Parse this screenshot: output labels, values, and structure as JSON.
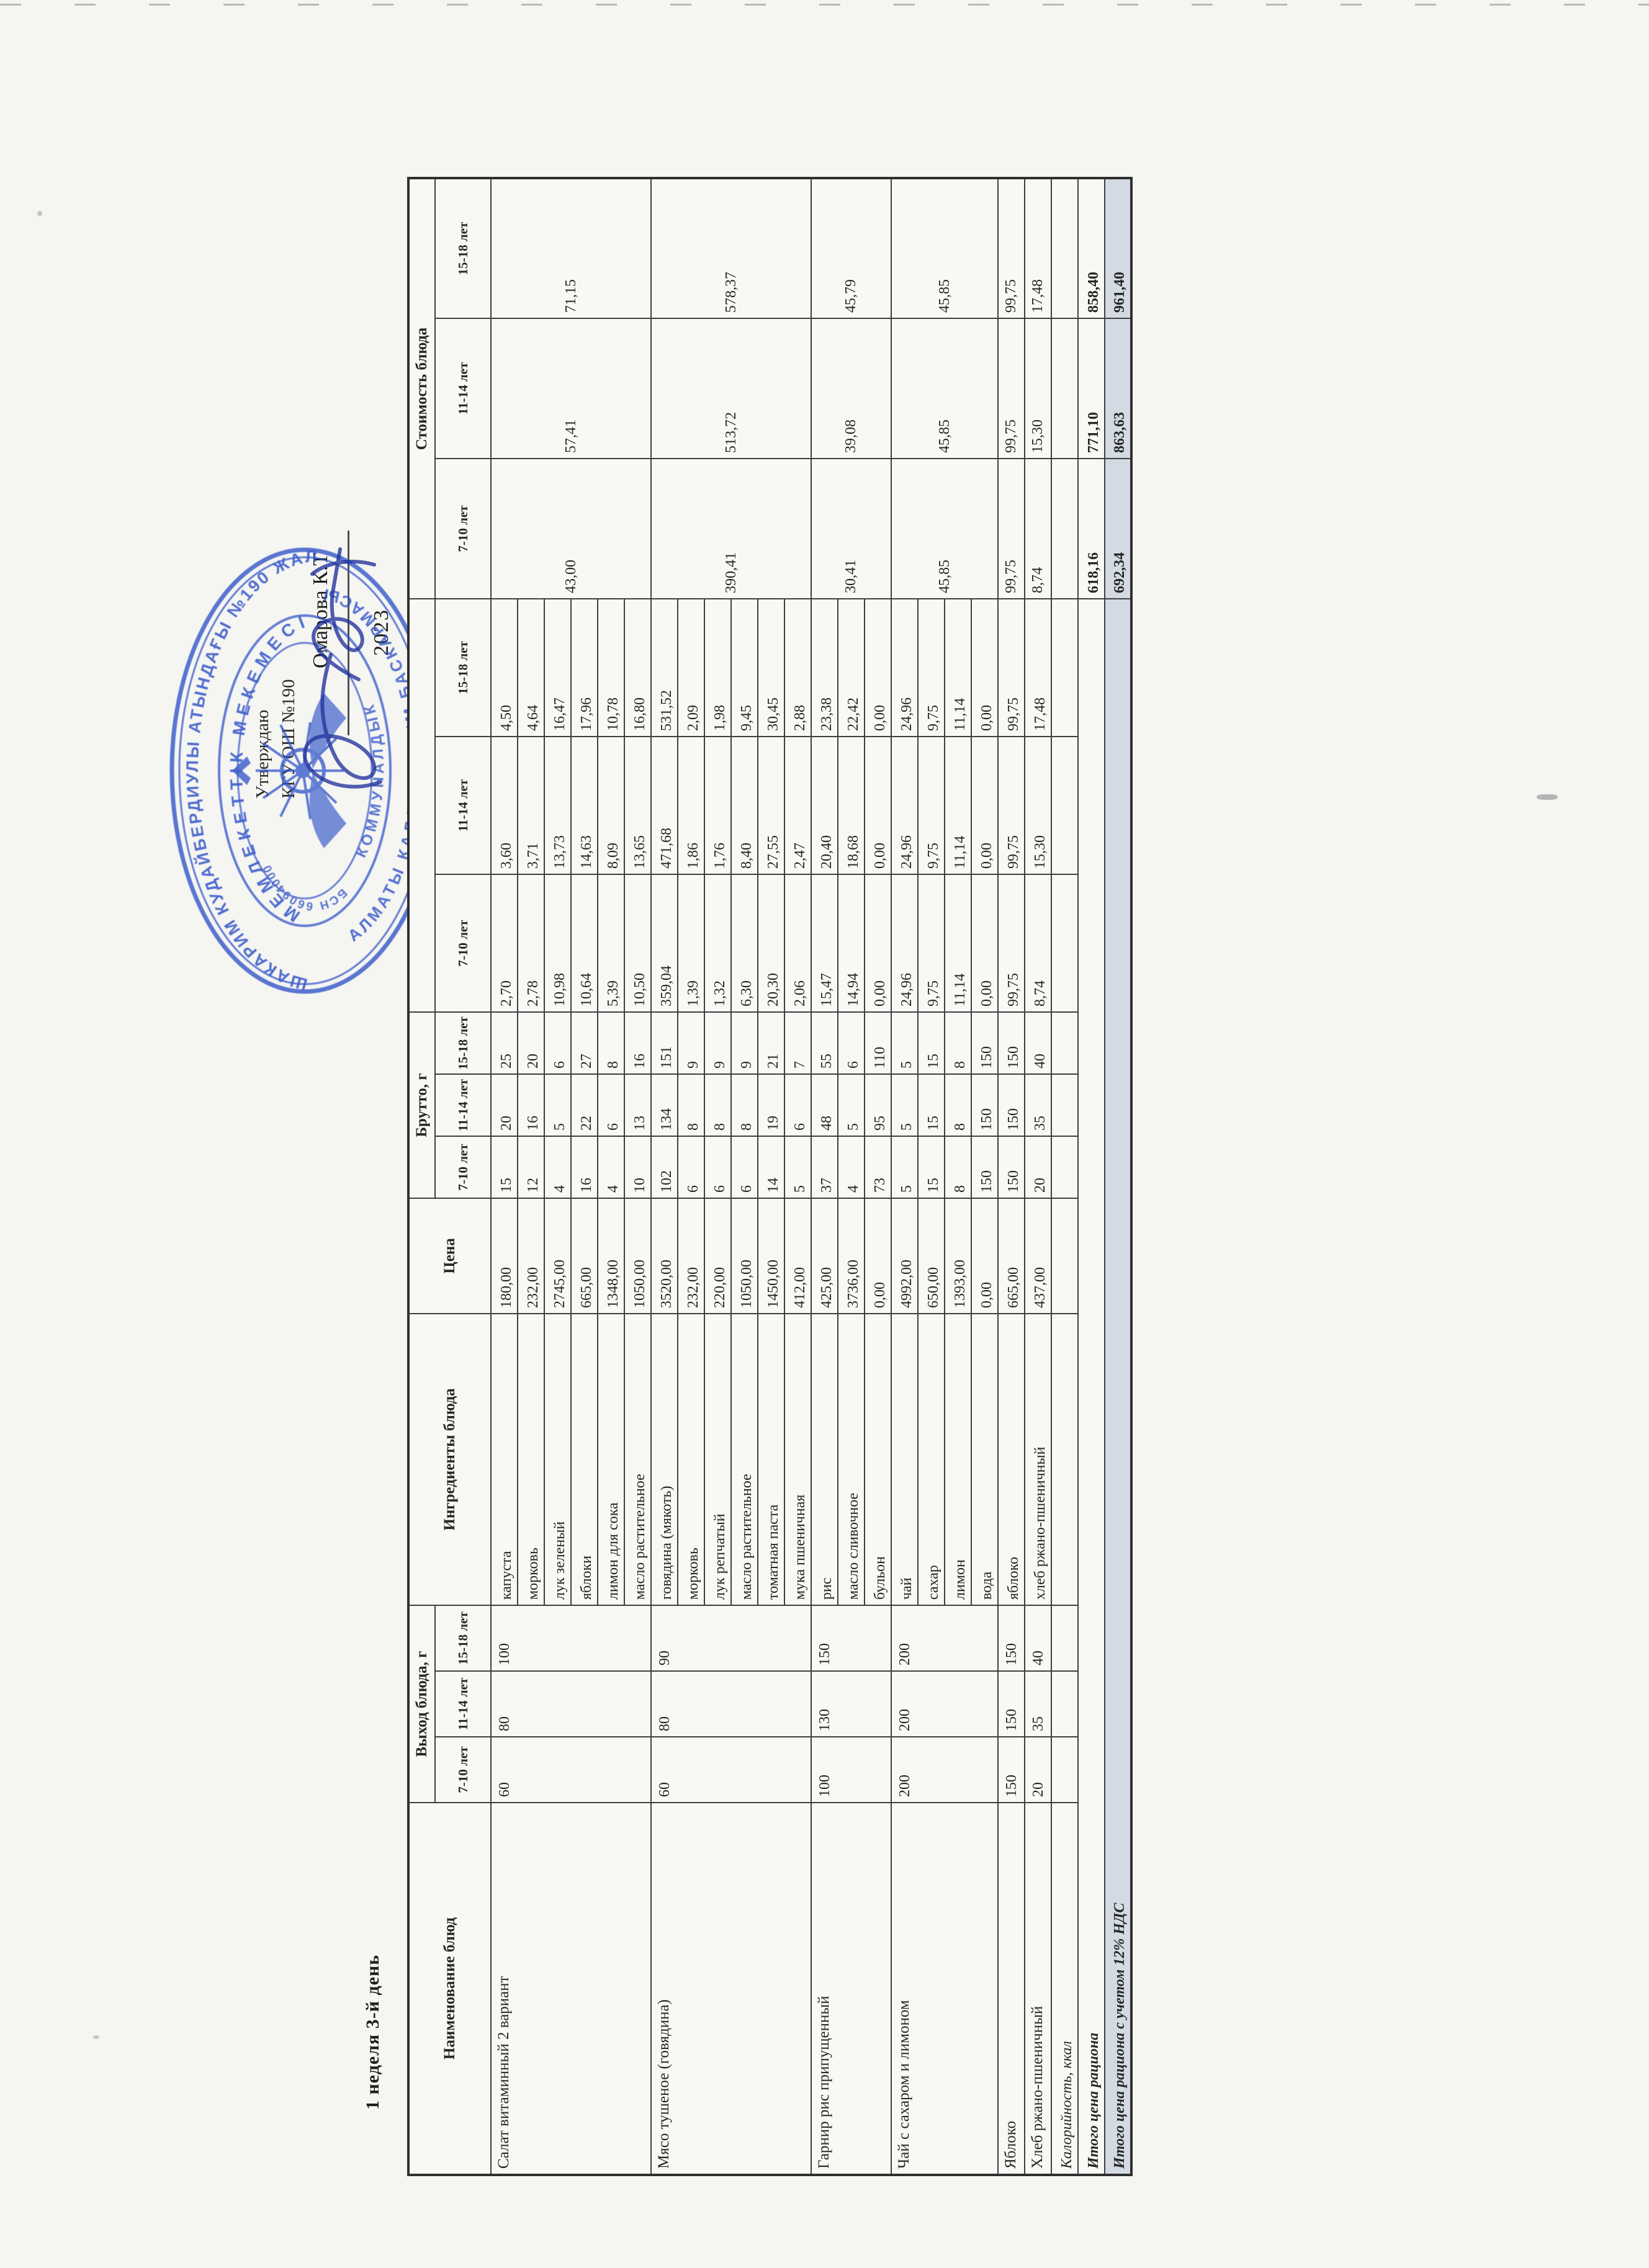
{
  "page": {
    "title": "1 неделя 3-й день"
  },
  "approval": {
    "approve_label": "Утверждаю",
    "org_label": "КГУ ОШ №190",
    "signer_name": "Омарова К.Т",
    "year": "2023",
    "stamp": {
      "ring_top": "ШАКАРИМ КУДАЙБЕРДИУЛЫ АТЫНДАҒЫ №190 ЖАЛПЫ БІЛІМ БЕРЕТІН",
      "ring_bottom": "АЛМАТЫ КАЛАСЫ БІЛІМ БАСКАРМАСЫНЫН",
      "inner_top": "МЕМЛЕКЕТТІК МЕКЕМЕСІ",
      "inner_bottom": "КОММУНАЛДЫК",
      "bin": "БСН 660940000038",
      "color": "#2f52c8"
    }
  },
  "table": {
    "headers": {
      "name": "Наименование блюд",
      "vyhod_group": "Выход блюда, г",
      "ingredients": "Ингредиенты блюда",
      "price": "Цена",
      "brutto_group": "Брутто, г",
      "cost_group": "",
      "total_group": "Стоимость блюда",
      "ages": [
        "7-10 лет",
        "11-14 лет",
        "15-18 лет"
      ]
    },
    "dishes": [
      {
        "name": "Салат витаминный 2 вариант",
        "vyhod": [
          "60",
          "80",
          "100"
        ],
        "totals": [
          "43,00",
          "57,41",
          "71,15"
        ],
        "ingredients": [
          {
            "name": "капуста",
            "price": "180,00",
            "brutto": [
              "15",
              "20",
              "25"
            ],
            "cost": [
              "2,70",
              "3,60",
              "4,50"
            ]
          },
          {
            "name": "морковь",
            "price": "232,00",
            "brutto": [
              "12",
              "16",
              "20"
            ],
            "cost": [
              "2,78",
              "3,71",
              "4,64"
            ]
          },
          {
            "name": "лук зеленый",
            "price": "2745,00",
            "brutto": [
              "4",
              "5",
              "6"
            ],
            "cost": [
              "10,98",
              "13,73",
              "16,47"
            ]
          },
          {
            "name": "яблоки",
            "price": "665,00",
            "brutto": [
              "16",
              "22",
              "27"
            ],
            "cost": [
              "10,64",
              "14,63",
              "17,96"
            ]
          },
          {
            "name": "лимон для сока",
            "price": "1348,00",
            "brutto": [
              "4",
              "6",
              "8"
            ],
            "cost": [
              "5,39",
              "8,09",
              "10,78"
            ]
          },
          {
            "name": "масло растительное",
            "price": "1050,00",
            "brutto": [
              "10",
              "13",
              "16"
            ],
            "cost": [
              "10,50",
              "13,65",
              "16,80"
            ]
          }
        ]
      },
      {
        "name": "Мясо тушеное (говядина)",
        "vyhod": [
          "60",
          "80",
          "90"
        ],
        "totals": [
          "390,41",
          "513,72",
          "578,37"
        ],
        "ingredients": [
          {
            "name": "говядина (мякоть)",
            "price": "3520,00",
            "brutto": [
              "102",
              "134",
              "151"
            ],
            "cost": [
              "359,04",
              "471,68",
              "531,52"
            ]
          },
          {
            "name": "морковь",
            "price": "232,00",
            "brutto": [
              "6",
              "8",
              "9"
            ],
            "cost": [
              "1,39",
              "1,86",
              "2,09"
            ]
          },
          {
            "name": "лук репчатый",
            "price": "220,00",
            "brutto": [
              "6",
              "8",
              "9"
            ],
            "cost": [
              "1,32",
              "1,76",
              "1,98"
            ]
          },
          {
            "name": "масло растительное",
            "price": "1050,00",
            "brutto": [
              "6",
              "8",
              "9"
            ],
            "cost": [
              "6,30",
              "8,40",
              "9,45"
            ]
          },
          {
            "name": "томатная паста",
            "price": "1450,00",
            "brutto": [
              "14",
              "19",
              "21"
            ],
            "cost": [
              "20,30",
              "27,55",
              "30,45"
            ]
          },
          {
            "name": "мука пшеничная",
            "price": "412,00",
            "brutto": [
              "5",
              "6",
              "7"
            ],
            "cost": [
              "2,06",
              "2,47",
              "2,88"
            ]
          }
        ]
      },
      {
        "name": "Гарнир рис припущенный",
        "vyhod": [
          "100",
          "130",
          "150"
        ],
        "totals": [
          "30,41",
          "39,08",
          "45,79"
        ],
        "ingredients": [
          {
            "name": "рис",
            "price": "425,00",
            "brutto": [
              "37",
              "48",
              "55"
            ],
            "cost": [
              "15,47",
              "20,40",
              "23,38"
            ]
          },
          {
            "name": "масло сливочное",
            "price": "3736,00",
            "brutto": [
              "4",
              "5",
              "6"
            ],
            "cost": [
              "14,94",
              "18,68",
              "22,42"
            ]
          },
          {
            "name": "бульон",
            "price": "0,00",
            "brutto": [
              "73",
              "95",
              "110"
            ],
            "cost": [
              "0,00",
              "0,00",
              "0,00"
            ]
          }
        ]
      },
      {
        "name": "Чай с сахаром и лимоном",
        "vyhod": [
          "200",
          "200",
          "200"
        ],
        "totals": [
          "45,85",
          "45,85",
          "45,85"
        ],
        "ingredients": [
          {
            "name": "чай",
            "price": "4992,00",
            "brutto": [
              "5",
              "5",
              "5"
            ],
            "cost": [
              "24,96",
              "24,96",
              "24,96"
            ]
          },
          {
            "name": "сахар",
            "price": "650,00",
            "brutto": [
              "15",
              "15",
              "15"
            ],
            "cost": [
              "9,75",
              "9,75",
              "9,75"
            ]
          },
          {
            "name": "лимон",
            "price": "1393,00",
            "brutto": [
              "8",
              "8",
              "8"
            ],
            "cost": [
              "11,14",
              "11,14",
              "11,14"
            ]
          },
          {
            "name": "вода",
            "price": "0,00",
            "brutto": [
              "150",
              "150",
              "150"
            ],
            "cost": [
              "0,00",
              "0,00",
              "0,00"
            ]
          }
        ]
      },
      {
        "name": "Яблоко",
        "vyhod": [
          "150",
          "150",
          "150"
        ],
        "totals": [
          "99,75",
          "99,75",
          "99,75"
        ],
        "ingredients": [
          {
            "name": "яблоко",
            "price": "665,00",
            "brutto": [
              "150",
              "150",
              "150"
            ],
            "cost": [
              "99,75",
              "99,75",
              "99,75"
            ]
          }
        ]
      },
      {
        "name": "Хлеб ржано-пшеничный",
        "vyhod": [
          "20",
          "35",
          "40"
        ],
        "totals": [
          "8,74",
          "15,30",
          "17,48"
        ],
        "ingredients": [
          {
            "name": "хлеб ржано-пшеничный",
            "price": "437,00",
            "brutto": [
              "20",
              "35",
              "40"
            ],
            "cost": [
              "8,74",
              "15,30",
              "17,48"
            ]
          }
        ]
      }
    ],
    "footer_rows": [
      {
        "label": "Калорийность, ккал",
        "values": [
          "",
          "",
          ""
        ],
        "bold": false,
        "spread": false,
        "highlight": false
      },
      {
        "label": "Итого цена рациона",
        "values": [
          "618,16",
          "771,10",
          "858,40"
        ],
        "bold": true,
        "spread": true,
        "highlight": false
      },
      {
        "label": "Итого цена рациона с учетом 12% НДС",
        "values": [
          "692,34",
          "863,63",
          "961,40"
        ],
        "bold": true,
        "spread": true,
        "highlight": true
      }
    ]
  }
}
